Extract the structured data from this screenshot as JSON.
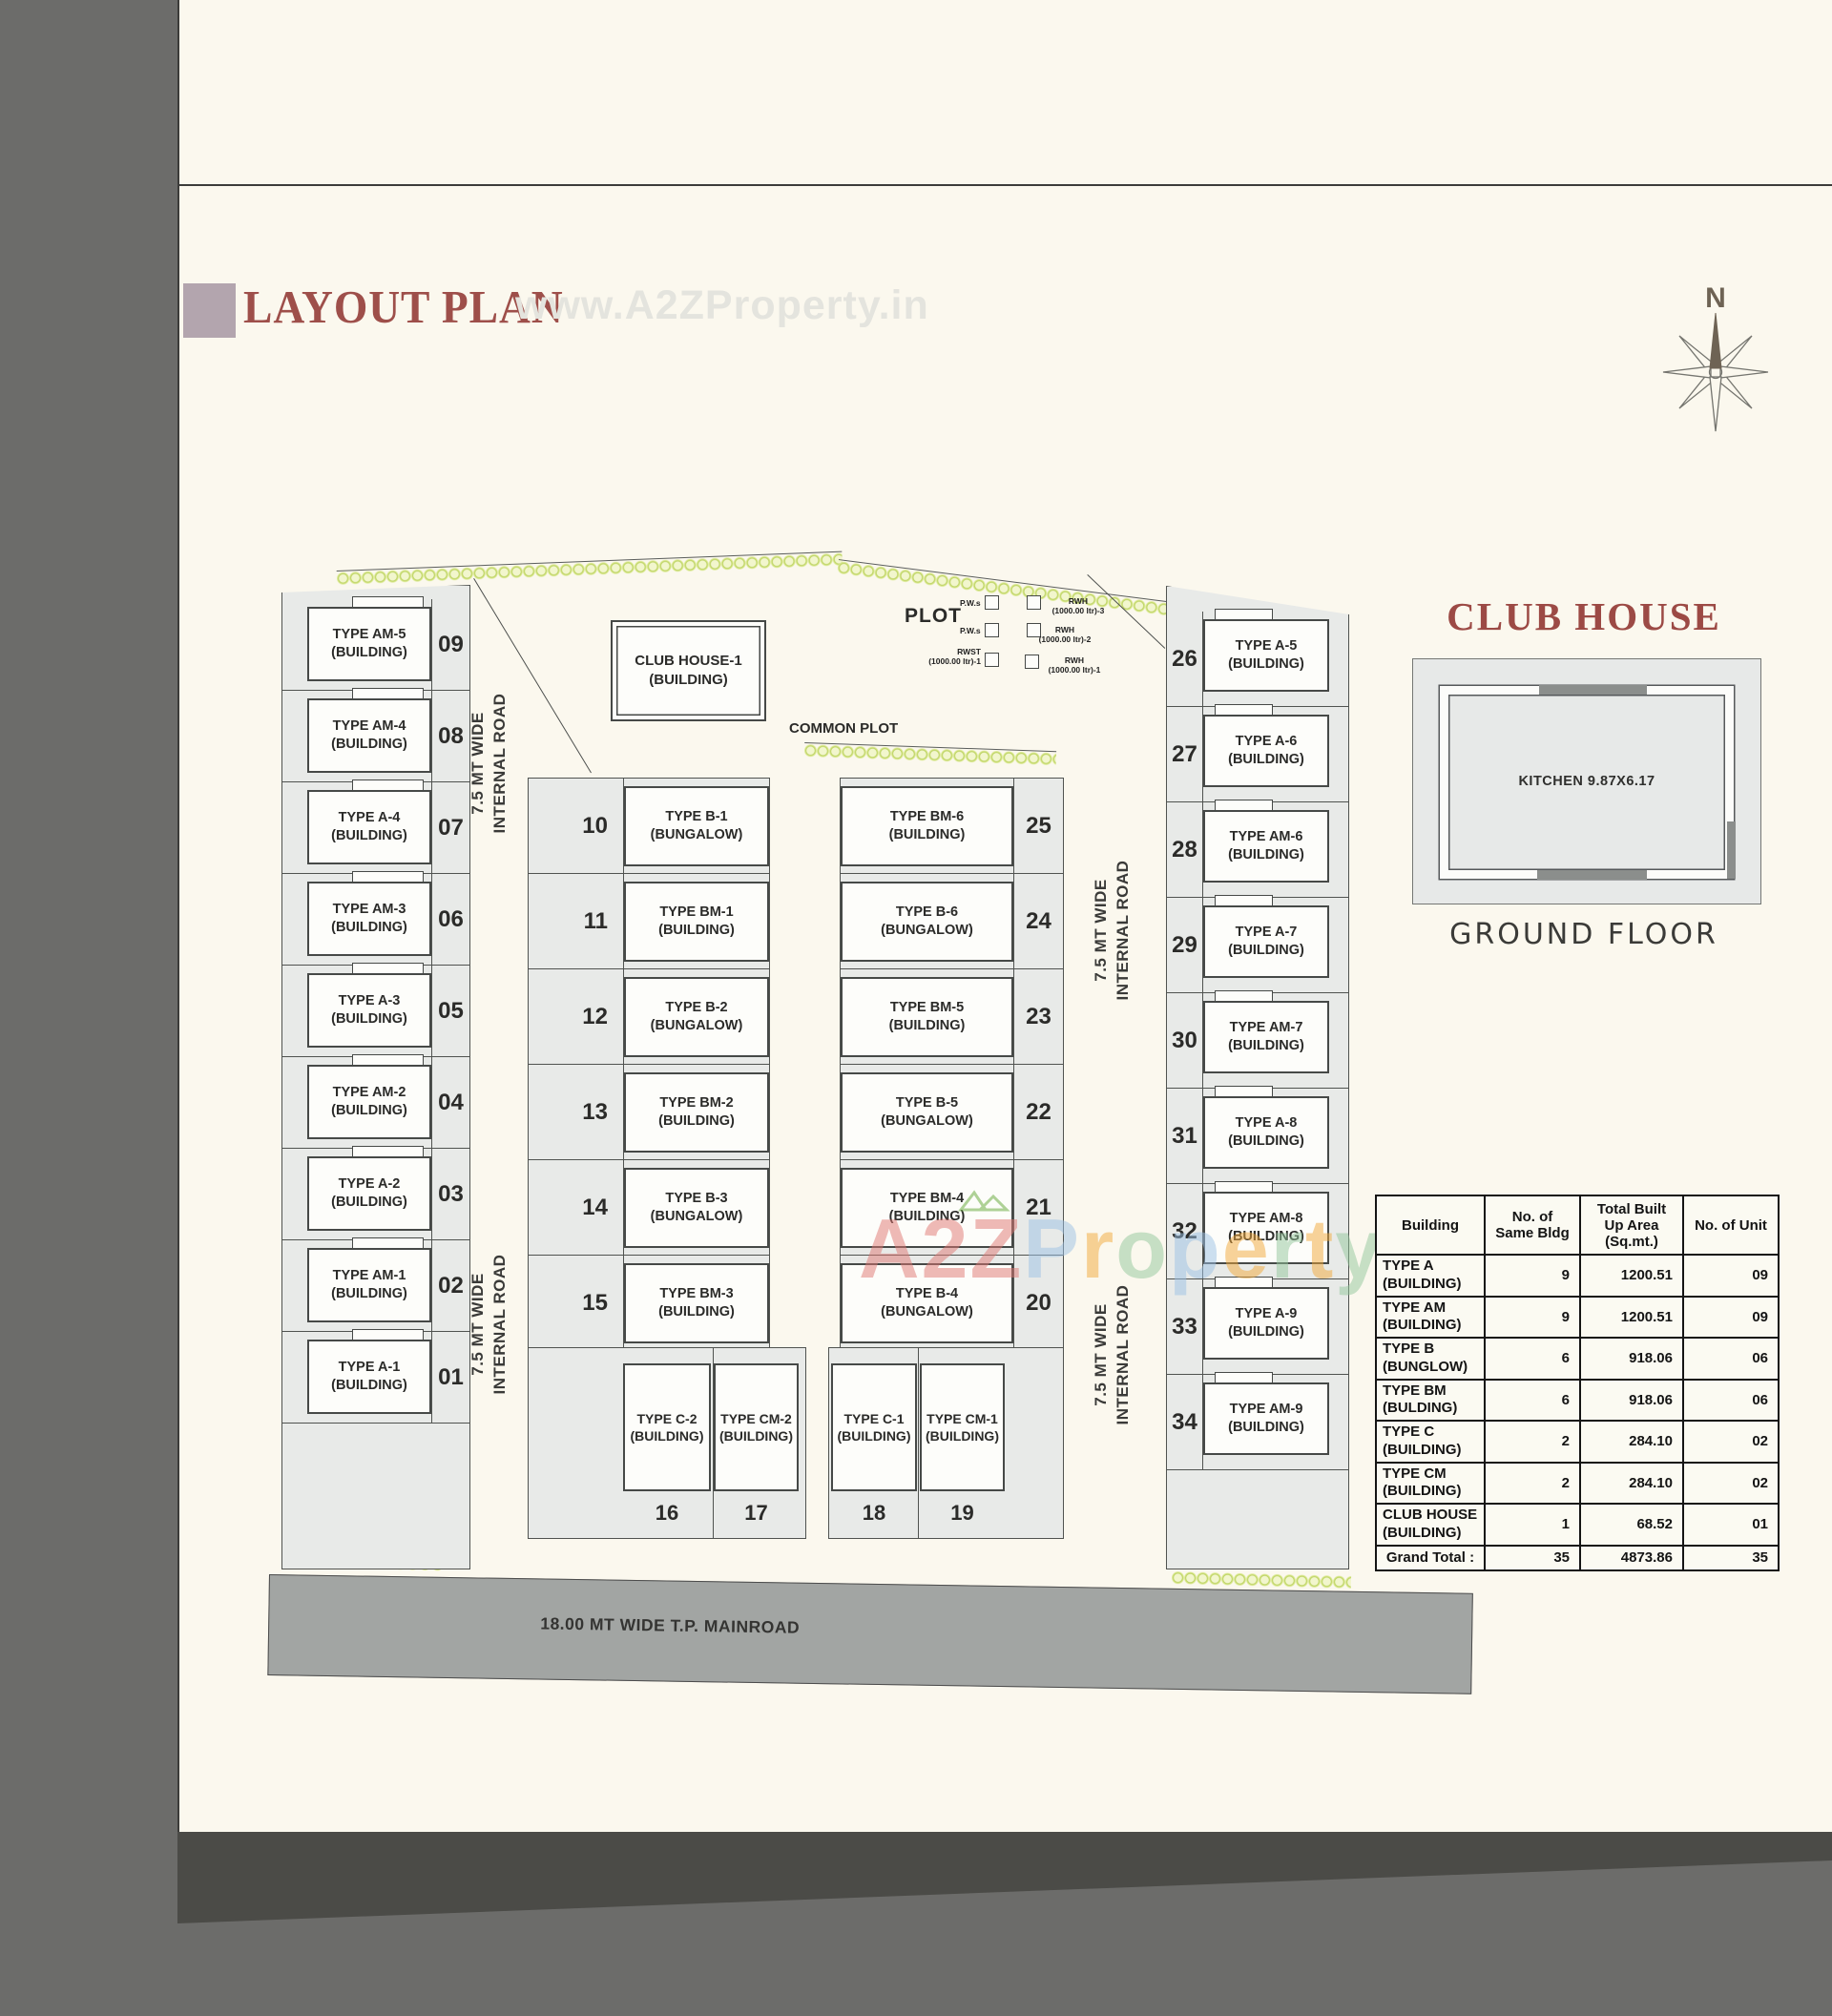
{
  "page": {
    "title": "LAYOUT PLAN",
    "watermark_top": "www.A2ZProperty.in",
    "watermark_a2z": "A2Z",
    "watermark_property": "Property"
  },
  "compass": {
    "north": "N"
  },
  "plan": {
    "common_plot": "COMMON PLOT",
    "plot": "PLOT",
    "main_road": "18.00 MT WIDE T.P. MAINROAD",
    "internal_road_line1": "7.5 MT WIDE",
    "internal_road_line2": "INTERNAL ROAD",
    "club_house_building": {
      "name": "CLUB HOUSE-1",
      "type": "(BUILDING)"
    },
    "rwh": {
      "pws1": "P.W.s",
      "pws2": "P.W.s",
      "rwst": "RWST\n(1000.00 ltr)-1",
      "rwh3": "RWH\n(1000.00 ltr)-3",
      "rwh2": "RWH\n(1000.00 ltr)-2",
      "rwh1": "RWH\n(1000.00 ltr)-1"
    },
    "left_column": [
      {
        "name": "TYPE AM-5",
        "type": "(BUILDING)",
        "no": "09"
      },
      {
        "name": "TYPE AM-4",
        "type": "(BUILDING)",
        "no": "08"
      },
      {
        "name": "TYPE A-4",
        "type": "(BUILDING)",
        "no": "07"
      },
      {
        "name": "TYPE AM-3",
        "type": "(BUILDING)",
        "no": "06"
      },
      {
        "name": "TYPE A-3",
        "type": "(BUILDING)",
        "no": "05"
      },
      {
        "name": "TYPE AM-2",
        "type": "(BUILDING)",
        "no": "04"
      },
      {
        "name": "TYPE A-2",
        "type": "(BUILDING)",
        "no": "03"
      },
      {
        "name": "TYPE AM-1",
        "type": "(BUILDING)",
        "no": "02"
      },
      {
        "name": "TYPE A-1",
        "type": "(BUILDING)",
        "no": "01"
      }
    ],
    "center_left": [
      {
        "name": "TYPE B-1",
        "type": "(BUNGALOW)",
        "no": "10"
      },
      {
        "name": "TYPE BM-1",
        "type": "(BUILDING)",
        "no": "11"
      },
      {
        "name": "TYPE B-2",
        "type": "(BUNGALOW)",
        "no": "12"
      },
      {
        "name": "TYPE BM-2",
        "type": "(BUILDING)",
        "no": "13"
      },
      {
        "name": "TYPE B-3",
        "type": "(BUNGALOW)",
        "no": "14"
      },
      {
        "name": "TYPE BM-3",
        "type": "(BUILDING)",
        "no": "15"
      }
    ],
    "center_right": [
      {
        "name": "TYPE BM-6",
        "type": "(BUILDING)",
        "no": "25"
      },
      {
        "name": "TYPE B-6",
        "type": "(BUNGALOW)",
        "no": "24"
      },
      {
        "name": "TYPE BM-5",
        "type": "(BUILDING)",
        "no": "23"
      },
      {
        "name": "TYPE B-5",
        "type": "(BUNGALOW)",
        "no": "22"
      },
      {
        "name": "TYPE BM-4",
        "type": "(BUILDING)",
        "no": "21"
      },
      {
        "name": "TYPE B-4",
        "type": "(BUNGALOW)",
        "no": "20"
      }
    ],
    "bottom_row": [
      {
        "name": "TYPE C-2",
        "type": "(BUILDING)",
        "no": "16"
      },
      {
        "name": "TYPE CM-2",
        "type": "(BUILDING)",
        "no": "17"
      },
      {
        "name": "TYPE C-1",
        "type": "(BUILDING)",
        "no": "18"
      },
      {
        "name": "TYPE CM-1",
        "type": "(BUILDING)",
        "no": "19"
      }
    ],
    "right_column": [
      {
        "name": "TYPE A-5",
        "type": "(BUILDING)",
        "no": "26"
      },
      {
        "name": "TYPE A-6",
        "type": "(BUILDING)",
        "no": "27"
      },
      {
        "name": "TYPE AM-6",
        "type": "(BUILDING)",
        "no": "28"
      },
      {
        "name": "TYPE A-7",
        "type": "(BUILDING)",
        "no": "29"
      },
      {
        "name": "TYPE AM-7",
        "type": "(BUILDING)",
        "no": "30"
      },
      {
        "name": "TYPE A-8",
        "type": "(BUILDING)",
        "no": "31"
      },
      {
        "name": "TYPE AM-8",
        "type": "(BUILDING)",
        "no": "32"
      },
      {
        "name": "TYPE A-9",
        "type": "(BUILDING)",
        "no": "33"
      },
      {
        "name": "TYPE AM-9",
        "type": "(BUILDING)",
        "no": "34"
      }
    ]
  },
  "club_house_detail": {
    "title": "CLUB HOUSE",
    "kitchen": "KITCHEN  9.87X6.17",
    "floor": "GROUND FLOOR"
  },
  "table": {
    "headers": [
      "Building",
      "No. of Same Bldg",
      "Total Built Up Area (Sq.mt.)",
      "No. of Unit"
    ],
    "rows": [
      {
        "name": "TYPE A",
        "type": "(BUILDING)",
        "count": "9",
        "area": "1200.51",
        "units": "09"
      },
      {
        "name": "TYPE AM",
        "type": "(BUILDING)",
        "count": "9",
        "area": "1200.51",
        "units": "09"
      },
      {
        "name": "TYPE B",
        "type": "(BUNGLOW)",
        "count": "6",
        "area": "918.06",
        "units": "06"
      },
      {
        "name": "TYPE BM",
        "type": "(BULDING)",
        "count": "6",
        "area": "918.06",
        "units": "06"
      },
      {
        "name": "TYPE C",
        "type": "(BUILDING)",
        "count": "2",
        "area": "284.10",
        "units": "02"
      },
      {
        "name": "TYPE CM",
        "type": "(BUILDING)",
        "count": "2",
        "area": "284.10",
        "units": "02"
      },
      {
        "name": "CLUB HOUSE",
        "type": "(BUILDING)",
        "count": "1",
        "area": "68.52",
        "units": "01"
      }
    ],
    "total": {
      "label": "Grand Total :",
      "count": "35",
      "area": "4873.86",
      "units": "35"
    }
  },
  "colors": {
    "title_red": "#9e4f4a",
    "mauve_square": "#b3a5ae",
    "plot_gray": "#e8eae8",
    "road_gray": "#a2a5a3",
    "tree_green": "#b8cf5b",
    "watermark_pink": "#e07873",
    "watermark_light_gray": "#e4e4de",
    "page_cream": "#fbf8ee"
  }
}
